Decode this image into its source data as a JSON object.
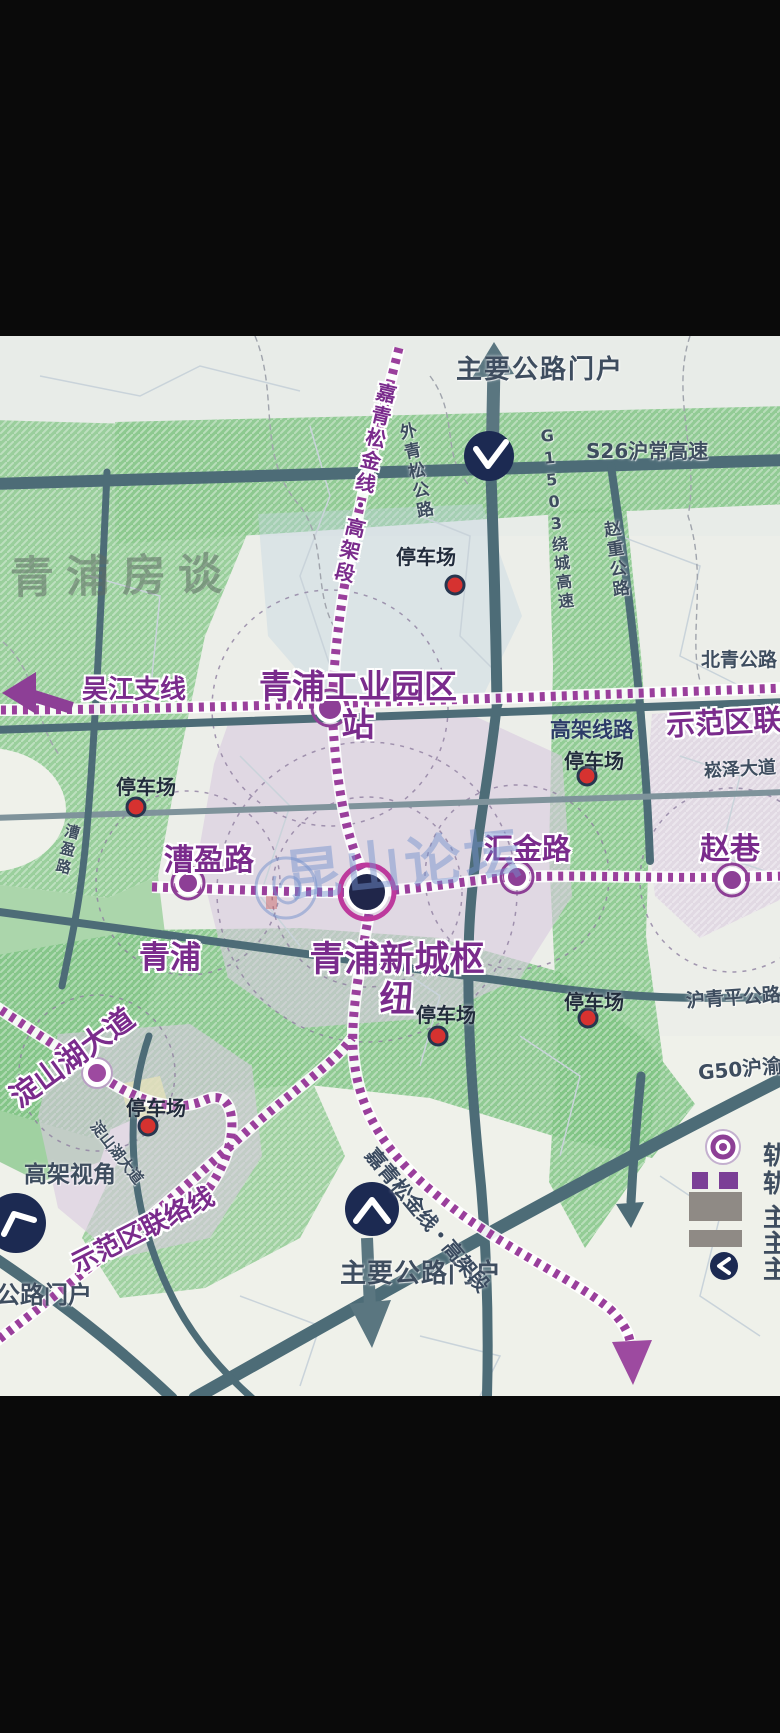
{
  "screen": {
    "width": 780,
    "height": 1733,
    "bars_color": "#0a0a0a"
  },
  "map": {
    "background": "#eff1ea",
    "watermark_brand": "青浦房谈",
    "watermark_forum": "昆山论坛",
    "labels": {
      "gateway_top": "主要公路门户",
      "gateway_bottom": "主要公路门户",
      "gateway_bottom_left": "主要公路门户",
      "s26": "S26沪常高速",
      "g1503": "G1503绕城高速",
      "waiqingsong": "外青松公路",
      "zhaozhong": "赵重公路",
      "beiqing": "北青公路",
      "songze": "崧泽大道",
      "huqingping": "沪青平公路",
      "g50": "G50沪渝",
      "wujiang": "吴江支线",
      "lianluo_right": "示范区联络线",
      "lianluo_bottom": "示范区联络线",
      "gaojia_line": "高架线路",
      "gaojia_view": "高架视角",
      "jqsj_top": "嘉青松金线・高架段",
      "jqsj_bottom": "嘉青松金线・高架段",
      "dianshanhu_road": "淀山湖大道",
      "caoying_road": "漕盈路",
      "qingpu": "青浦"
    },
    "stations": {
      "industrial_park": "青浦工业园区站",
      "caoying": "漕盈路",
      "huijin": "汇金路",
      "zhaoxiang": "赵巷",
      "hub": "青浦新城枢纽",
      "dianshanhu": "淀山湖大道"
    },
    "parking_label": "停车场",
    "legend_partial": [
      "轨",
      "轨",
      "主",
      "主",
      "主"
    ],
    "colors": {
      "rail_purple": "#9a3f9c",
      "road_teal": "#4d6c77",
      "green_area": "#82c586",
      "lavender_area": "#d9c9df",
      "navy_badge": "#1c2a52",
      "parking_red": "#d63230",
      "label_purple": "#7a2b8c",
      "label_slate": "#3e4d5f"
    }
  }
}
